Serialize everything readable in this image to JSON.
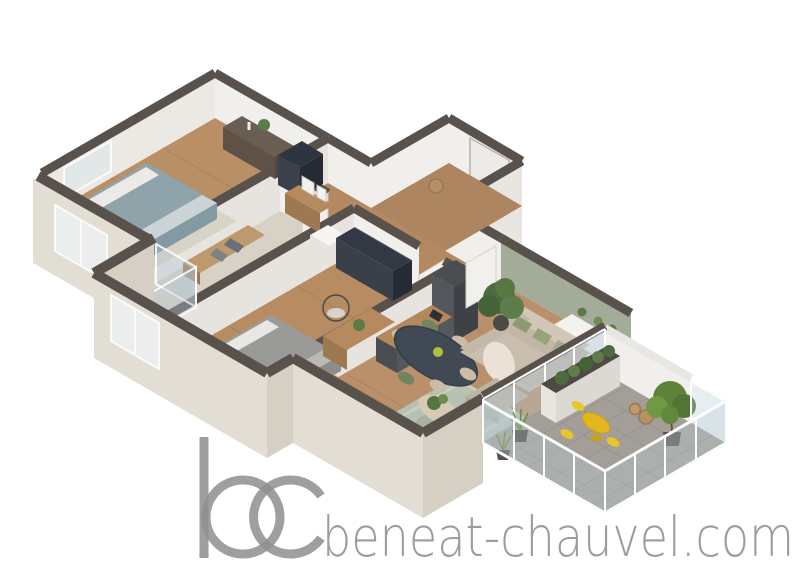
{
  "watermark": {
    "logo_text": "bc",
    "site_text": "beneat-chauvel.com"
  },
  "palette": {
    "background": "#ffffff",
    "wall_top_dark": "#59514b",
    "wall_white": "#f1efec",
    "wall_green_accent": "#a2ac98",
    "exterior_beige": "#e3ded4",
    "wood_floor": "#b98f66",
    "bath_floor": "#d8d2c6",
    "balcony_tile": "#a39f98",
    "sofa_beige": "#c9bdad",
    "cushion_green": "#8c9a72",
    "rug_sage": "#b6c1b1",
    "accent_yellow": "#e2b71e",
    "plant_green": "#4e6b3f",
    "kitchen_charcoal": "#54585c",
    "counter_oak": "#b4875c",
    "bed1_teal": "#8fa3ab",
    "bed2_gray": "#9a9a98",
    "logo_gray": "#8e8e8e",
    "watermark_gray": "#9c9c9c"
  },
  "scene": {
    "type": "isometric-3d-floor-plan-render",
    "rooms": [
      {
        "name": "bedroom-1",
        "floor": "wood",
        "furniture": [
          "double-bed",
          "rug",
          "dark-dresser",
          "wardrobe",
          "plant"
        ]
      },
      {
        "name": "hallway",
        "floor": "wood",
        "furniture": [
          "console-table",
          "picture-frames"
        ]
      },
      {
        "name": "entry-hall",
        "floor": "wood",
        "furniture": [
          "front-door",
          "coat-hooks",
          "basket"
        ]
      },
      {
        "name": "bathroom",
        "floor": "stone",
        "furniture": [
          "wood-bench",
          "towels",
          "washbasin",
          "glass-shower"
        ]
      },
      {
        "name": "bedroom-2",
        "floor": "wood",
        "furniture": [
          "double-bed",
          "oak-dresser",
          "wire-chair",
          "dark-wardrobe",
          "plant"
        ]
      },
      {
        "name": "kitchen",
        "floor": "wood",
        "furniture": [
          "tall-fridge-column",
          "l-shaped-counter",
          "sink",
          "coffee-machine"
        ]
      },
      {
        "name": "living-dining-room",
        "accent_wall": "sage-green",
        "furniture": [
          "dining-table",
          "six-chairs",
          "sofa",
          "green-cushions",
          "throw-blanket",
          "ottoman",
          "round-coffee-table",
          "sage-rug",
          "wall-shelf",
          "potted-plants"
        ]
      },
      {
        "name": "balcony",
        "floor": "tile",
        "furniture": [
          "white-planter",
          "yellow-bistro-table",
          "yellow-chairs",
          "potted-grasses",
          "potted-tree",
          "wicker-baskets",
          "glass-railing"
        ]
      }
    ]
  }
}
